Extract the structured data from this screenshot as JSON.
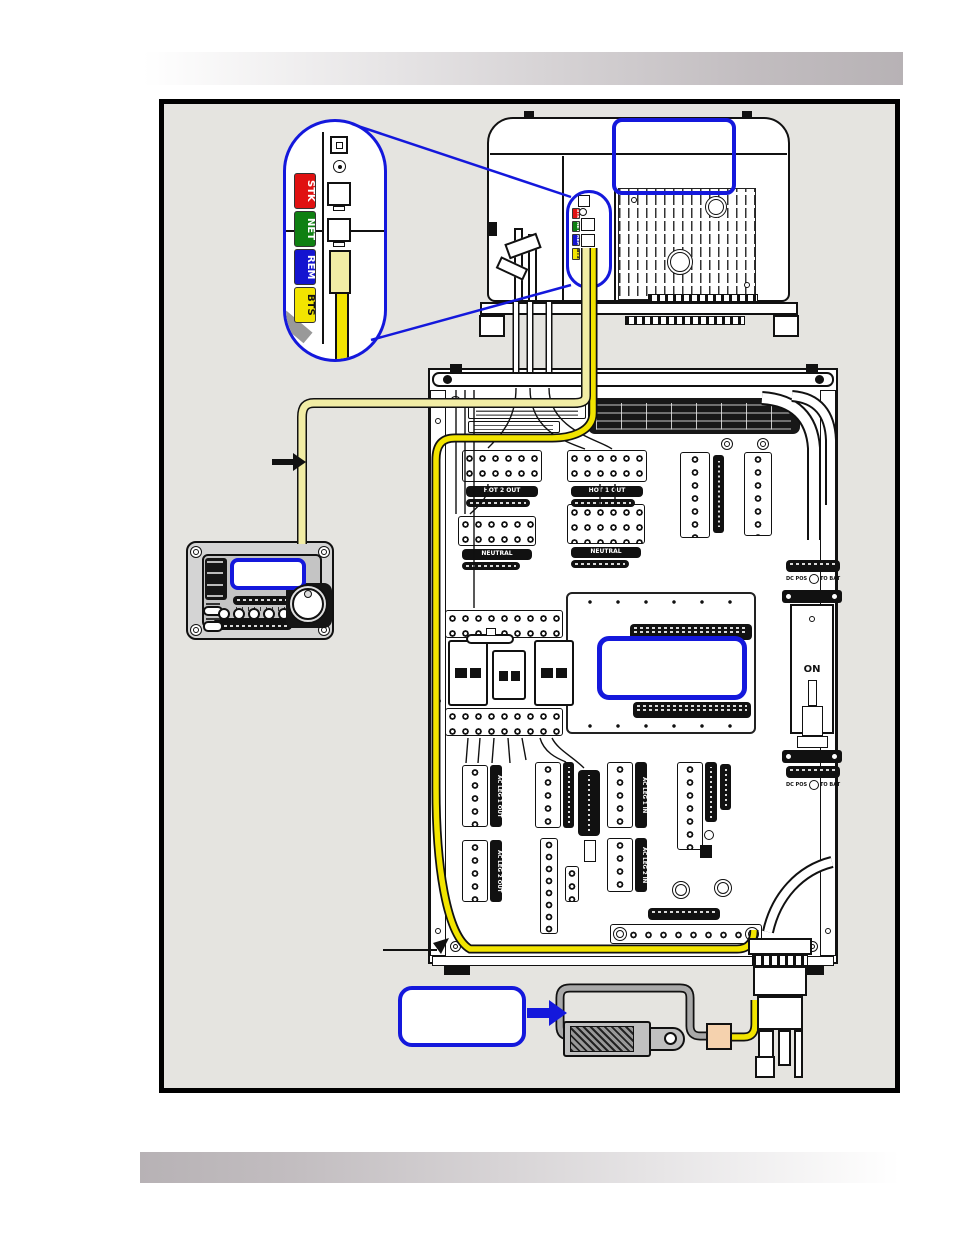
{
  "ports": {
    "labels": [
      {
        "text": "STK",
        "color": "#e01111"
      },
      {
        "text": "NET",
        "color": "#0f8012"
      },
      {
        "text": "REM",
        "color": "#1414d0"
      },
      {
        "text": "BTS",
        "color": "#f2e400"
      }
    ]
  },
  "load_center": {
    "hot2_out": "HOT 2 OUT",
    "hot1_out": "HOT 1 OUT",
    "neutral": "NEUTRAL",
    "ac_leg_1_out": "AC LEG 1 OUT",
    "ac_leg_2_out": "AC LEG 2 OUT",
    "ac_leg_1_in": "AC LEG 1 IN",
    "ac_leg_2_in": "AC LEG 2 IN",
    "breaker_on": "ON",
    "dc_pos": "DC POS",
    "to_bat": "TO BAT"
  },
  "colors": {
    "callout_blue": "#1418dc",
    "cable_pale_yellow": "#f2eda5",
    "cable_bright_yellow": "#f2e400",
    "sensor_gray": "#a8a8a8",
    "connector_tan": "#f5d2ae",
    "diagram_background": "#e5e4e0"
  }
}
